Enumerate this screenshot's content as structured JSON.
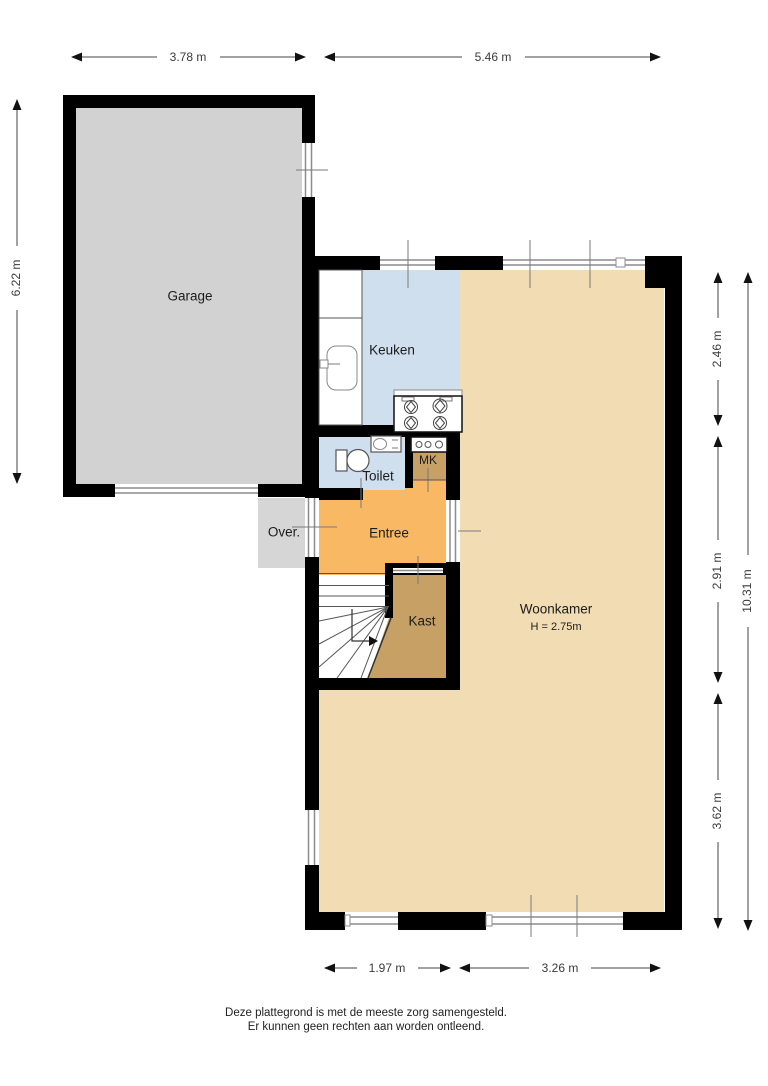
{
  "plan": {
    "rooms": {
      "garage": {
        "label": "Garage"
      },
      "keuken": {
        "label": "Keuken"
      },
      "toilet": {
        "label": "Toilet"
      },
      "mk": {
        "label": "MK"
      },
      "entree": {
        "label": "Entree"
      },
      "over": {
        "label": "Over."
      },
      "kast": {
        "label": "Kast"
      },
      "woonkamer": {
        "label": "Woonkamer",
        "ceiling_height": "H = 2.75m"
      }
    },
    "dimensions": {
      "garage_width": "3.78 m",
      "house_width": "5.46 m",
      "garage_depth": "6.22 m",
      "right_top": "2.46 m",
      "right_middle": "2.91 m",
      "right_bottom": "3.62 m",
      "right_total": "10.31 m",
      "bottom_left": "1.97 m",
      "bottom_right": "3.26 m"
    },
    "footer": {
      "line1": "Deze plattegrond is met de meeste zorg samengesteld.",
      "line2": "Er kunnen geen rechten aan worden ontleend."
    },
    "colors": {
      "wall": "#000000",
      "garage_floor": "#d2d2d2",
      "kitchen_floor": "#cfdfed",
      "living_floor": "#f2dcb3",
      "hall_floor": "#f9b863",
      "closet_floor": "#c7a066",
      "outdoor_floor": "#d6d6d6",
      "background": "#ffffff"
    }
  }
}
